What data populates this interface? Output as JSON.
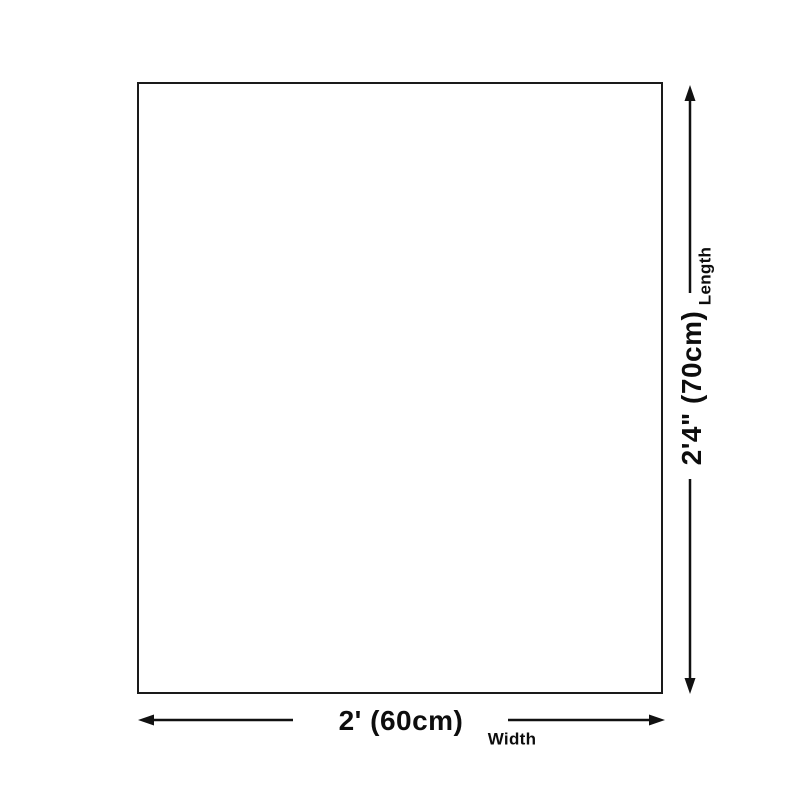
{
  "diagram": {
    "title": "product-size-diagram",
    "width": {
      "value": "2' (60cm)",
      "label": "Width"
    },
    "length": {
      "value": "2'4\" (70cm)",
      "label": "Length"
    }
  },
  "colors": {
    "background": "#ffffff",
    "outline": "#1a1a1a",
    "arrow": "#111111",
    "text": "#0d0d0d"
  }
}
